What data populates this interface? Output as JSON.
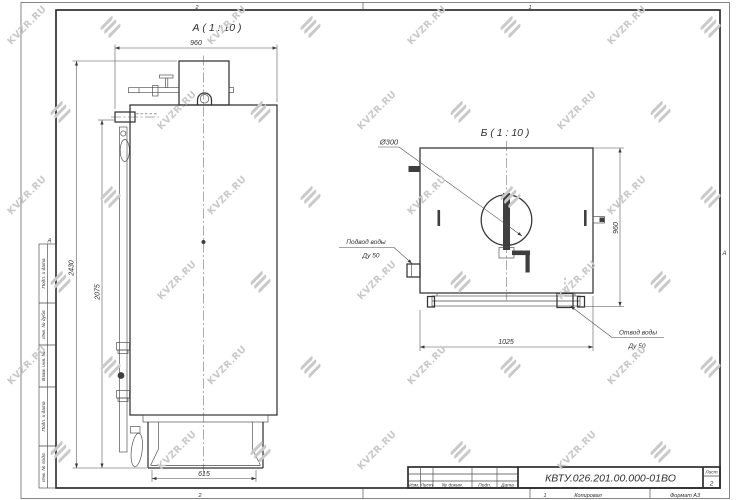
{
  "watermark": {
    "text": "KVZR.RU"
  },
  "frame": {
    "zone_cols_top": [
      "2",
      "1"
    ],
    "zone_cols_bottom": [
      "2",
      "1"
    ],
    "zone_row_left": "А",
    "zone_row_right": "А",
    "side_fields": [
      "Подп. и дата",
      "Инв. № дубл.",
      "Взам. инв. №",
      "Подп. и дата",
      "Инв. № подл."
    ],
    "footer": {
      "copied": "Копировал",
      "format": "Формат А3"
    }
  },
  "view_a": {
    "title": "А ( 1 : 10 )",
    "dim_width_top": "960",
    "dim_height_overall": "2430",
    "dim_height_body": "2075",
    "dim_base_width": "615"
  },
  "view_b": {
    "title": "Б ( 1 : 10 )",
    "dim_diameter": "Ø300",
    "dim_height": "960",
    "dim_width": "1025",
    "label_inlet_1": "Подвод воды",
    "label_inlet_2": "Ду 50",
    "label_outlet_1": "Отвод воды",
    "label_outlet_2": "Ду 50"
  },
  "title_block": {
    "doc_number": "КВТУ.026.201.00.000-01ВО",
    "columns": [
      "Изм.",
      "Лист",
      "№ докум.",
      "Подп.",
      "Дата"
    ],
    "sheet_label": "Лист",
    "sheet_number": "2"
  }
}
